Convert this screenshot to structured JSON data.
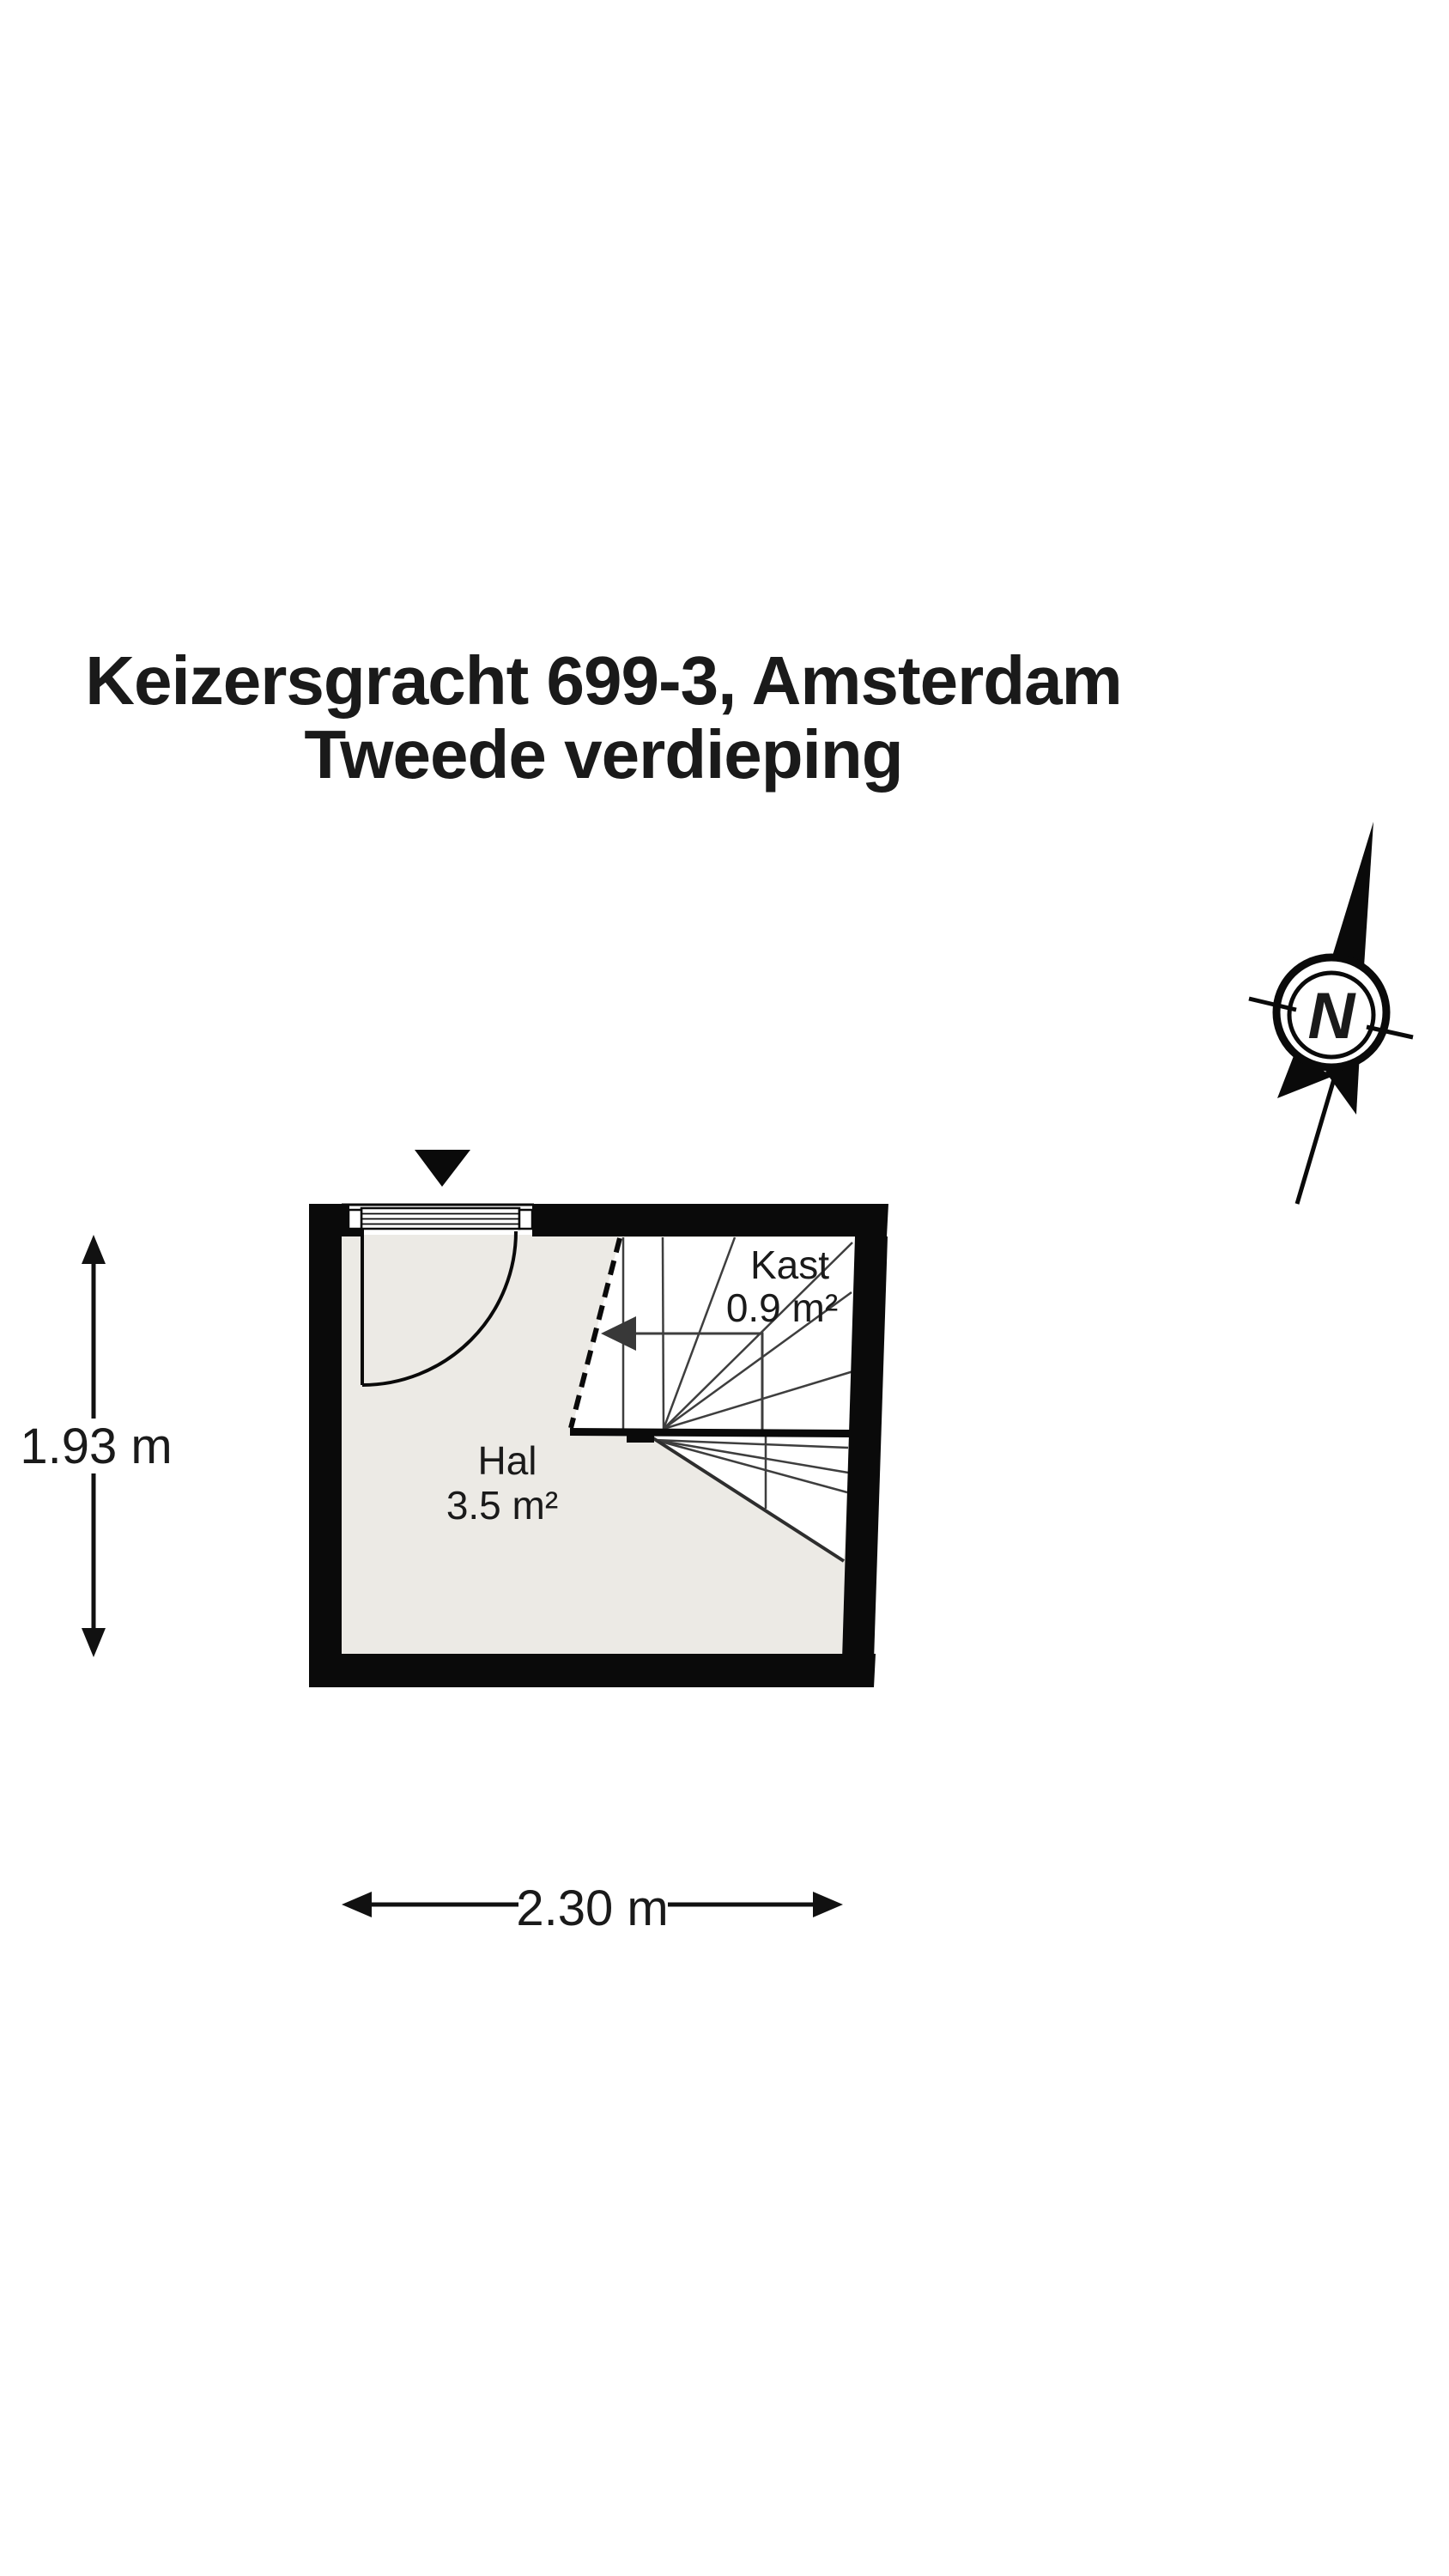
{
  "title": {
    "line1": "Keizersgracht 699-3, Amsterdam",
    "line2": "Tweede verdieping"
  },
  "compass": {
    "label": "N"
  },
  "floor_plan": {
    "rooms": [
      {
        "name": "Hal",
        "area": "3.5 m²"
      },
      {
        "name": "Kast",
        "area": "0.9 m²"
      }
    ]
  },
  "dimensions": {
    "height_label": "1.93 m",
    "width_label": "2.30 m"
  },
  "colors": {
    "wall": "#0a0a0a",
    "floor_hal": "#eceae5",
    "floor_stairs": "#ffffff",
    "stair_line": "#3e3e3e",
    "text": "#1a1a1a"
  }
}
